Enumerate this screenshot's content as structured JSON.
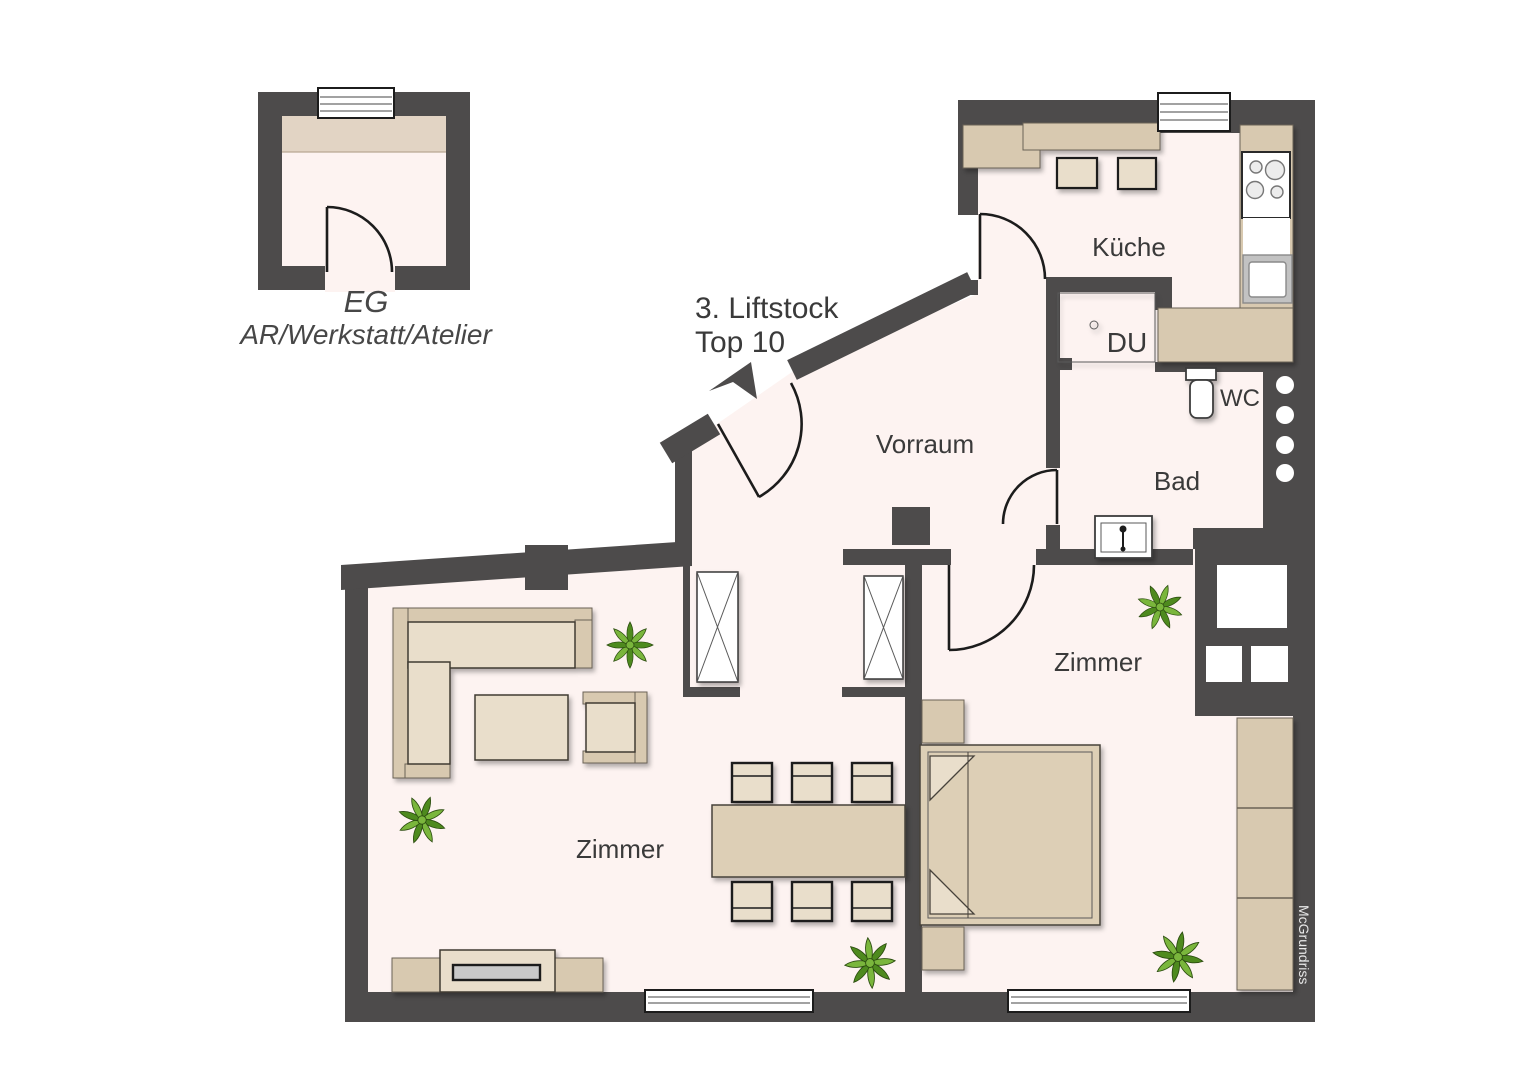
{
  "inset": {
    "floor_label": "EG",
    "room_label": "AR/Werkstatt/Atelier"
  },
  "entrance": {
    "line1": "3. Liftstock",
    "line2": "Top 10"
  },
  "rooms": {
    "hall": "Vorraum",
    "kitchen": "Küche",
    "shower": "DU",
    "wc": "WC",
    "bath": "Bad",
    "living": "Zimmer",
    "bedroom": "Zimmer"
  },
  "watermark": "McGrundriss",
  "colors": {
    "wall": "#4d4b4b",
    "floor": "#fdf3f1",
    "white": "#ffffff",
    "furnLight": "#e9decb",
    "furnMid": "#ddcfb6",
    "furnDark": "#d8c9b0",
    "tvScreen": "#c9c9c9",
    "text": "#3a3a3a",
    "plantDark": "#4e8a1e",
    "plantLight": "#7ab63c",
    "watermarkText": "#e8e8e8"
  }
}
